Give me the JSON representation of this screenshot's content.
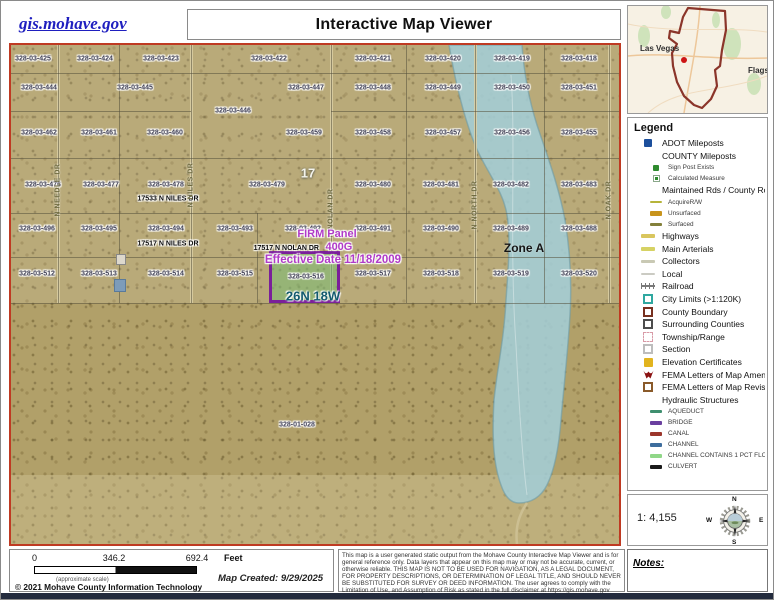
{
  "header": {
    "site": "gis.mohave.gov",
    "title": "Interactive Map Viewer"
  },
  "inset": {
    "labels": [
      {
        "text": "Las Vegas",
        "x": 12,
        "y": 38
      },
      {
        "text": "Flagstaff",
        "x": 120,
        "y": 60
      }
    ]
  },
  "legend": {
    "title": "Legend",
    "items": [
      {
        "label": "ADOT Mileposts",
        "icon": "square",
        "color": "#1c4f9c",
        "w": 8,
        "h": 8,
        "indent": 0
      },
      {
        "label": "COUNTY Mileposts",
        "icon": "none",
        "indent": 0
      },
      {
        "label": "Sign Post Exists",
        "icon": "square",
        "color": "#2e8b2e",
        "w": 6,
        "h": 6,
        "indent": 1
      },
      {
        "label": "Calculated Measure",
        "icon": "square-dot",
        "color": "#2e8b2e",
        "indent": 1
      },
      {
        "label": "Maintained Rds / County Routes",
        "icon": "none",
        "indent": 0
      },
      {
        "label": "AcquireR/W",
        "icon": "line",
        "color": "#b6b43a",
        "w": 12,
        "h": 2,
        "indent": 1
      },
      {
        "label": "Unsurfaced",
        "icon": "line",
        "color": "#c8941c",
        "w": 12,
        "h": 5,
        "indent": 1
      },
      {
        "label": "Surfaced",
        "icon": "line",
        "color": "#83803a",
        "w": 12,
        "h": 3,
        "indent": 1
      },
      {
        "label": "Highways",
        "icon": "line",
        "color": "#d9c65e",
        "w": 14,
        "h": 4,
        "indent": 0
      },
      {
        "label": "Main Arterials",
        "icon": "line",
        "color": "#d6d264",
        "w": 14,
        "h": 4,
        "indent": 0
      },
      {
        "label": "Collectors",
        "icon": "line",
        "color": "#c9c9b4",
        "w": 14,
        "h": 3,
        "indent": 0
      },
      {
        "label": "Local",
        "icon": "line",
        "color": "#cbcbc3",
        "w": 14,
        "h": 2,
        "indent": 0
      },
      {
        "label": "Railroad",
        "icon": "railroad",
        "color": "#787878",
        "indent": 0
      },
      {
        "label": "City Limits (>1:120K)",
        "icon": "box",
        "color": "#2fa8a0",
        "indent": 0
      },
      {
        "label": "County Boundary",
        "icon": "box",
        "color": "#77301f",
        "indent": 0
      },
      {
        "label": "Surrounding Counties",
        "icon": "box",
        "color": "#4d4d4d",
        "indent": 0
      },
      {
        "label": "Township/Range",
        "icon": "box-dashed",
        "color": "#d89aa6",
        "indent": 0
      },
      {
        "label": "Section",
        "icon": "box",
        "color": "#bdbdbd",
        "indent": 0
      },
      {
        "label": "Elevation Certificates",
        "icon": "square",
        "color": "#e2b41e",
        "w": 9,
        "h": 9,
        "indent": 0
      },
      {
        "label": "FEMA Letters of Map Amendme",
        "icon": "fema",
        "color": "#8b1212",
        "indent": 0
      },
      {
        "label": "FEMA Letters of Map Revision",
        "icon": "box",
        "color": "#8a5a2a",
        "indent": 0
      },
      {
        "label": "Hydraulic Structures",
        "icon": "none",
        "indent": 0
      },
      {
        "label": "AQUEDUCT",
        "icon": "line",
        "color": "#3f8f6f",
        "w": 12,
        "h": 3,
        "indent": 1
      },
      {
        "label": "BRIDGE",
        "icon": "line",
        "color": "#6a3f9f",
        "w": 12,
        "h": 4,
        "indent": 1
      },
      {
        "label": "CANAL",
        "icon": "line",
        "color": "#9c362c",
        "w": 12,
        "h": 4,
        "indent": 1
      },
      {
        "label": "CHANNEL",
        "icon": "line",
        "color": "#3d6d9d",
        "w": 12,
        "h": 4,
        "indent": 1
      },
      {
        "label": "CHANNEL CONTAINS 1 PCT FLOOD",
        "icon": "line",
        "color": "#90d788",
        "w": 12,
        "h": 4,
        "indent": 1
      },
      {
        "label": "CULVERT",
        "icon": "line",
        "color": "#1a1a1a",
        "w": 12,
        "h": 4,
        "indent": 1
      }
    ]
  },
  "map": {
    "border_color": "#bf3a22",
    "zone_fill": "#a6ced8",
    "section_label": "17",
    "zone_label": "Zone A",
    "big_parcel": "328-01-028",
    "firm": {
      "title": "FIRM Panel",
      "address": "17517 N NOLAN DR",
      "panel": "400G",
      "effective": "Effective Date 11/18/2009",
      "parcel_id": "328-03-516",
      "township": "26N 18W",
      "box_color": "#7a1f9a",
      "text_color": "#b03ac8",
      "township_color": "#135a6e"
    },
    "parcels": [
      {
        "id": "328-03-425",
        "x": 22,
        "y": 14
      },
      {
        "id": "328-03-424",
        "x": 84,
        "y": 14
      },
      {
        "id": "328-03-423",
        "x": 150,
        "y": 14
      },
      {
        "id": "328-03-422",
        "x": 258,
        "y": 14
      },
      {
        "id": "328-03-421",
        "x": 362,
        "y": 14
      },
      {
        "id": "328-03-420",
        "x": 432,
        "y": 14
      },
      {
        "id": "328-03-419",
        "x": 501,
        "y": 14
      },
      {
        "id": "328-03-418",
        "x": 568,
        "y": 14
      },
      {
        "id": "328-03-444",
        "x": 28,
        "y": 43
      },
      {
        "id": "328-03-445",
        "x": 124,
        "y": 43
      },
      {
        "id": "328-03-446",
        "x": 222,
        "y": 66
      },
      {
        "id": "328-03-447",
        "x": 295,
        "y": 43
      },
      {
        "id": "328-03-448",
        "x": 362,
        "y": 43
      },
      {
        "id": "328-03-449",
        "x": 432,
        "y": 43
      },
      {
        "id": "328-03-450",
        "x": 501,
        "y": 43
      },
      {
        "id": "328-03-451",
        "x": 568,
        "y": 43
      },
      {
        "id": "328-03-462",
        "x": 28,
        "y": 88
      },
      {
        "id": "328-03-461",
        "x": 88,
        "y": 88
      },
      {
        "id": "328-03-460",
        "x": 154,
        "y": 88
      },
      {
        "id": "328-03-459",
        "x": 293,
        "y": 88
      },
      {
        "id": "328-03-458",
        "x": 362,
        "y": 88
      },
      {
        "id": "328-03-457",
        "x": 432,
        "y": 88
      },
      {
        "id": "328-03-456",
        "x": 501,
        "y": 88
      },
      {
        "id": "328-03-455",
        "x": 568,
        "y": 88
      },
      {
        "id": "328-03-476",
        "x": 32,
        "y": 140
      },
      {
        "id": "328-03-477",
        "x": 90,
        "y": 140
      },
      {
        "id": "328-03-478",
        "x": 155,
        "y": 140
      },
      {
        "id": "328-03-479",
        "x": 256,
        "y": 140
      },
      {
        "id": "328-03-480",
        "x": 362,
        "y": 140
      },
      {
        "id": "328-03-481",
        "x": 430,
        "y": 140
      },
      {
        "id": "328-03-482",
        "x": 500,
        "y": 140
      },
      {
        "id": "328-03-483",
        "x": 568,
        "y": 140
      },
      {
        "id": "328-03-496",
        "x": 26,
        "y": 184
      },
      {
        "id": "328-03-495",
        "x": 88,
        "y": 184
      },
      {
        "id": "328-03-494",
        "x": 155,
        "y": 184
      },
      {
        "id": "328-03-493",
        "x": 224,
        "y": 184
      },
      {
        "id": "328-03-492",
        "x": 292,
        "y": 184
      },
      {
        "id": "328-03-491",
        "x": 362,
        "y": 184
      },
      {
        "id": "328-03-490",
        "x": 430,
        "y": 184
      },
      {
        "id": "328-03-489",
        "x": 500,
        "y": 184
      },
      {
        "id": "328-03-488",
        "x": 568,
        "y": 184
      },
      {
        "id": "328-03-512",
        "x": 26,
        "y": 229
      },
      {
        "id": "328-03-513",
        "x": 88,
        "y": 229
      },
      {
        "id": "328-03-514",
        "x": 155,
        "y": 229
      },
      {
        "id": "328-03-515",
        "x": 224,
        "y": 229
      },
      {
        "id": "328-03-517",
        "x": 362,
        "y": 229
      },
      {
        "id": "328-03-518",
        "x": 430,
        "y": 229
      },
      {
        "id": "328-03-519",
        "x": 500,
        "y": 229
      },
      {
        "id": "328-03-520",
        "x": 568,
        "y": 229
      }
    ],
    "addresses": [
      {
        "text": "17533 N NILES DR",
        "x": 157,
        "y": 154
      },
      {
        "text": "17517 N NILES DR",
        "x": 157,
        "y": 199
      }
    ],
    "streets": [
      {
        "name": "N NEEDLE DR",
        "x": 47,
        "y": 145
      },
      {
        "name": "N NILES DR",
        "x": 180,
        "y": 140
      },
      {
        "name": "N NOLAN DR",
        "x": 320,
        "y": 168
      },
      {
        "name": "N NORTH DR",
        "x": 464,
        "y": 160
      },
      {
        "name": "N OAK DR",
        "x": 598,
        "y": 155
      }
    ]
  },
  "scale_panel": {
    "ratio": "1: 4,155",
    "compass": [
      "N",
      "E",
      "S",
      "W"
    ]
  },
  "notes": {
    "label": "Notes:"
  },
  "scalebar": {
    "ticks": [
      "0",
      "346.2",
      "692.4"
    ],
    "unit": "Feet",
    "approx": "(approximate scale)",
    "copyright": "© 2021 Mohave County Information Technology",
    "created": "Map Created: 9/29/2025"
  },
  "disclaimer": "This map is a user generated static output from the Mohave County Interactive Map Viewer and is for general reference only. Data layers that appear on this map may or may not be accurate, current, or otherwise reliable. THIS MAP IS NOT TO BE USED FOR NAVIGATION, AS A LEGAL DOCUMENT, FOR PROPERTY DESCRIPTIONS, OR DETERMINATION OF LEGAL TITLE, AND SHOULD NEVER BE SUBSTITUTED FOR SURVEY OR DEED INFORMATION. The user agrees to comply with the Limitation of Use, and Assumption of Risk as stated in the full disclaimer at https://gis.mohave.gov"
}
